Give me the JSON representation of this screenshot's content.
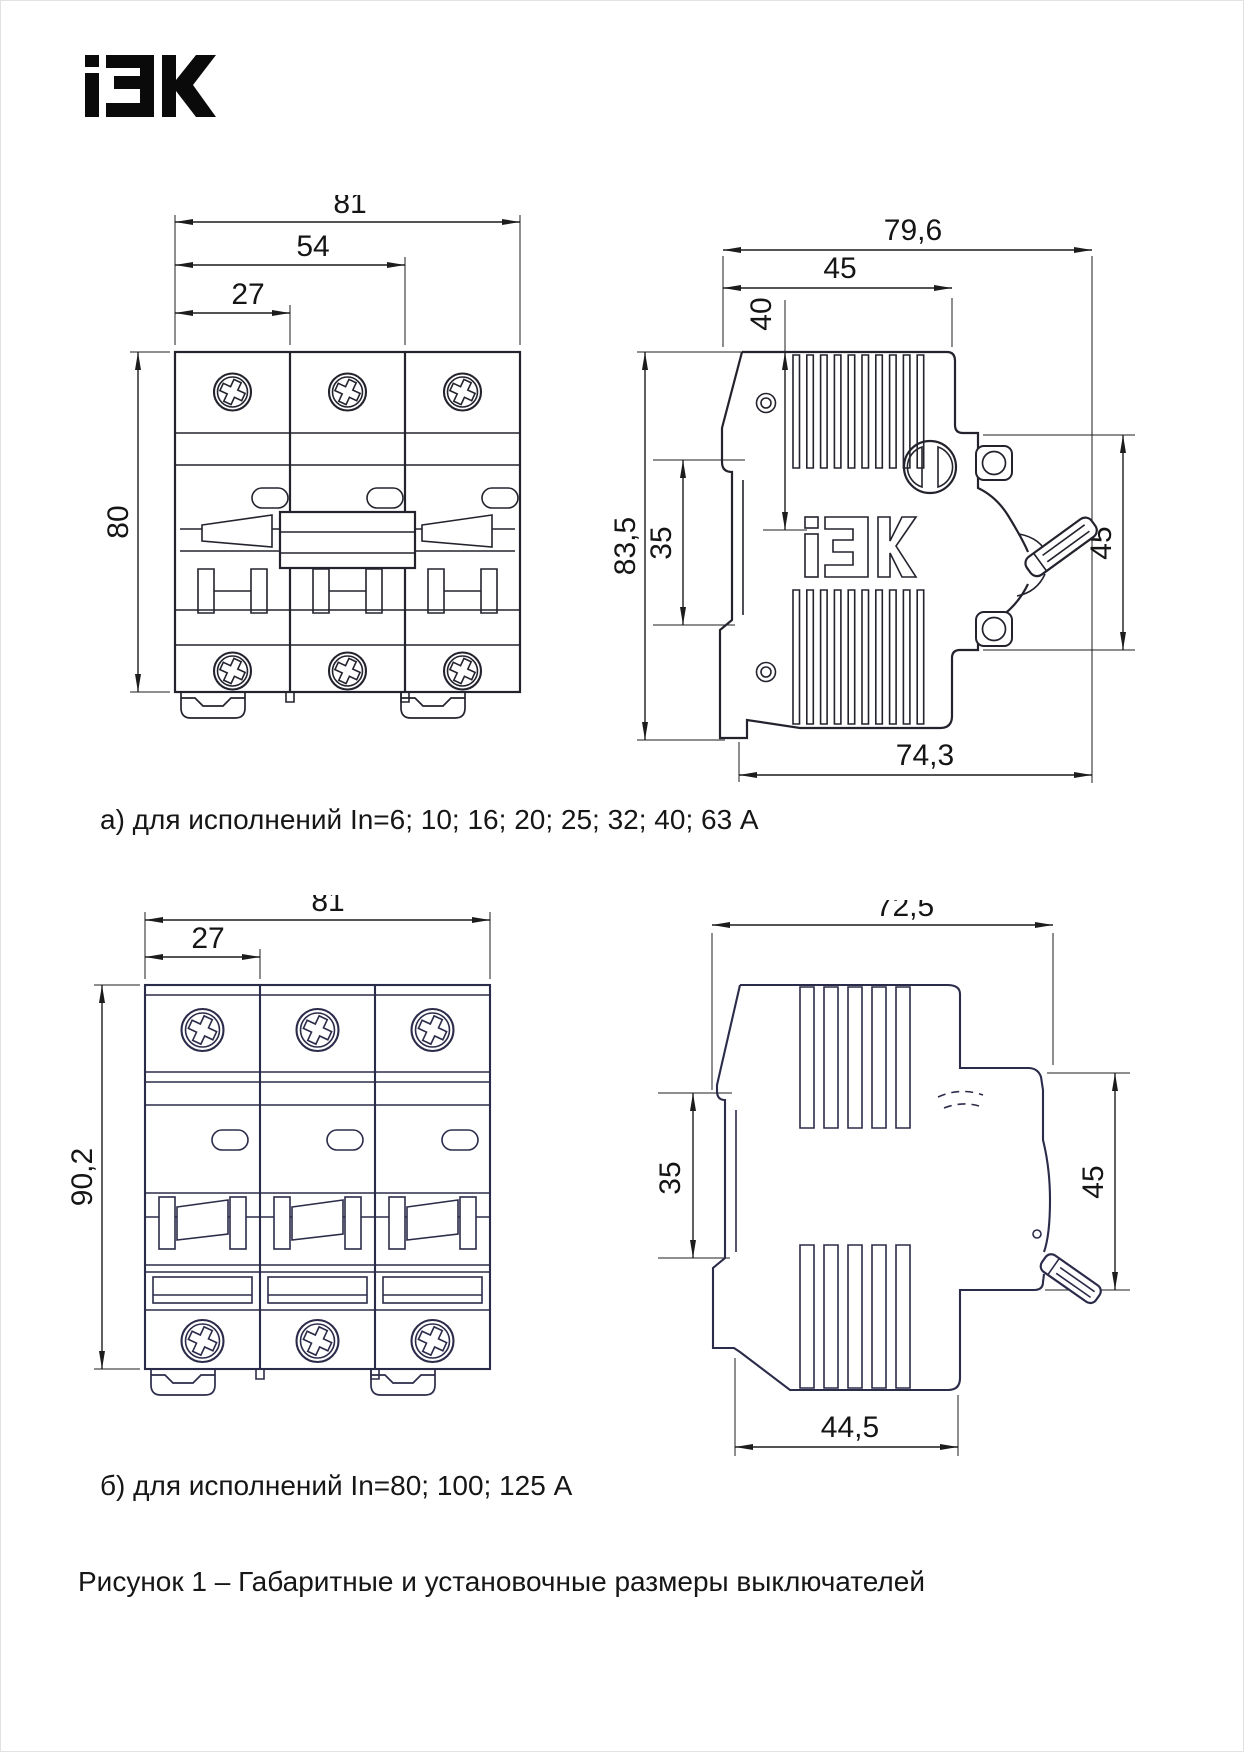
{
  "logo": {
    "brand": "iEK"
  },
  "captions": {
    "variant_a": "а) для исполнений In=6; 10; 16; 20; 25; 32; 40; 63 А",
    "variant_b": "б) для исполнений In=80; 100; 125 А",
    "figure": "Рисунок 1 – Габаритные и установочные размеры выключателей"
  },
  "colors": {
    "line_a": "#23232e",
    "line_b": "#2b2b4a",
    "dim": "#1c1c1c"
  },
  "drawing_a": {
    "front_view": {
      "dims": {
        "width_total": "81",
        "width_two_modules": "54",
        "width_module": "27",
        "height": "80"
      }
    },
    "side_view": {
      "embossed_logo": "iEK",
      "dims": {
        "depth_total": "79,6",
        "depth_body": "45",
        "handle_offset": "40",
        "height_total": "83,5",
        "din_channel": "35",
        "front_height": "45",
        "depth_base": "74,3"
      }
    }
  },
  "drawing_b": {
    "front_view": {
      "dims": {
        "width_total": "81",
        "width_module": "27",
        "height": "90,2"
      }
    },
    "side_view": {
      "dims": {
        "depth_total": "72,5",
        "din_channel": "35",
        "front_height": "45",
        "depth_base": "44,5"
      }
    }
  }
}
